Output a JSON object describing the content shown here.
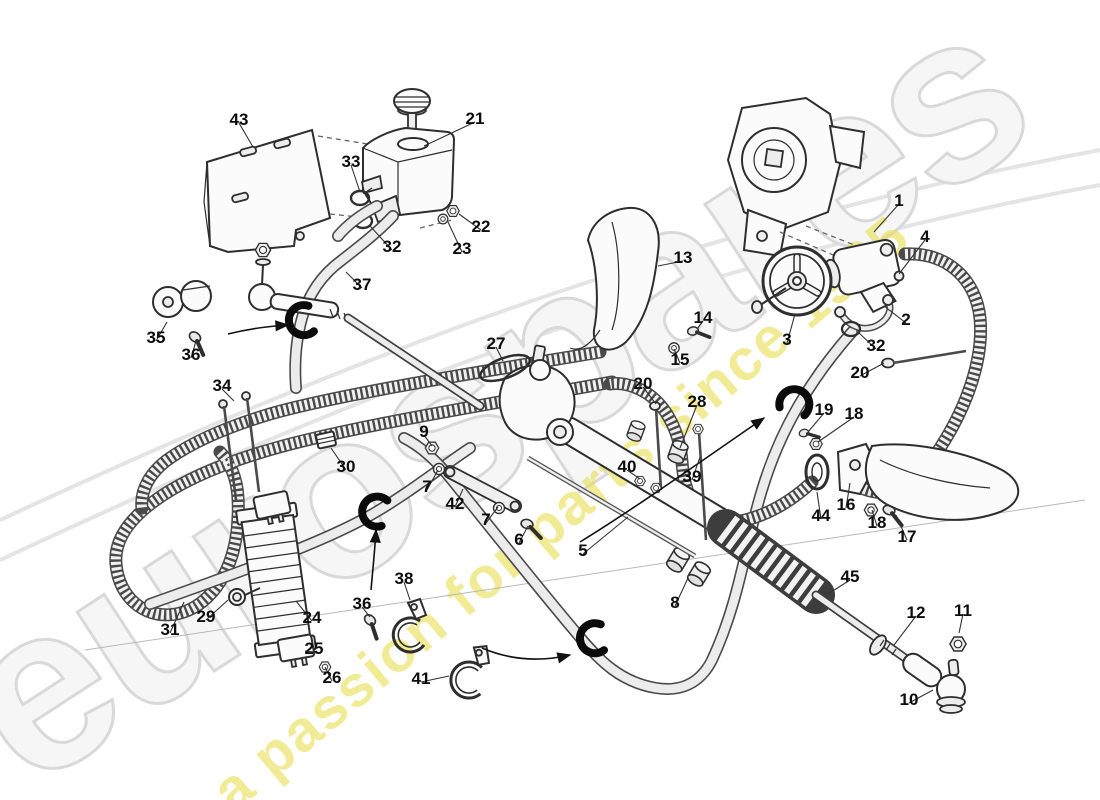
{
  "diagram": {
    "type": "exploded-parts-diagram",
    "subject": "power steering system",
    "watermark": {
      "name": "eurospares",
      "tagline": "a passion for parts since 1985",
      "logo_color": "#d9d9d9",
      "tagline_color": "#e9df55"
    },
    "callout_style": {
      "font_px": 17,
      "color": "#0d0d0d"
    },
    "callouts": [
      {
        "label": "1",
        "x": 899,
        "y": 200,
        "lx": 874,
        "ly": 232
      },
      {
        "label": "2",
        "x": 906,
        "y": 319,
        "lx": 884,
        "ly": 306
      },
      {
        "label": "3",
        "x": 787,
        "y": 339,
        "lx": 795,
        "ly": 314
      },
      {
        "label": "4",
        "x": 925,
        "y": 236,
        "lx": 899,
        "ly": 274
      },
      {
        "label": "5",
        "x": 583,
        "y": 550,
        "lx": 628,
        "ly": 517
      },
      {
        "label": "6",
        "x": 519,
        "y": 539,
        "lx": 528,
        "ly": 526
      },
      {
        "label": "7",
        "x": 427,
        "y": 486,
        "lx": 438,
        "ly": 470
      },
      {
        "label": "7",
        "x": 486,
        "y": 519,
        "lx": 498,
        "ly": 507
      },
      {
        "label": "8",
        "x": 675,
        "y": 602,
        "lx": 688,
        "ly": 578
      },
      {
        "label": "9",
        "x": 424,
        "y": 431,
        "lx": 432,
        "ly": 446
      },
      {
        "label": "10",
        "x": 909,
        "y": 699,
        "lx": 933,
        "ly": 690
      },
      {
        "label": "11",
        "x": 963,
        "y": 610,
        "lx": 959,
        "ly": 633
      },
      {
        "label": "12",
        "x": 916,
        "y": 612,
        "lx": 894,
        "ly": 645
      },
      {
        "label": "13",
        "x": 683,
        "y": 257,
        "lx": 658,
        "ly": 266
      },
      {
        "label": "14",
        "x": 703,
        "y": 317,
        "lx": 697,
        "ly": 329
      },
      {
        "label": "15",
        "x": 680,
        "y": 359,
        "lx": 674,
        "ly": 349
      },
      {
        "label": "16",
        "x": 846,
        "y": 504,
        "lx": 850,
        "ly": 483
      },
      {
        "label": "17",
        "x": 907,
        "y": 536,
        "lx": 896,
        "ly": 515
      },
      {
        "label": "18",
        "x": 854,
        "y": 413,
        "lx": 818,
        "ly": 442
      },
      {
        "label": "18",
        "x": 877,
        "y": 522,
        "lx": 872,
        "ly": 510
      },
      {
        "label": "19",
        "x": 824,
        "y": 409,
        "lx": 808,
        "ly": 432
      },
      {
        "label": "20",
        "x": 643,
        "y": 383,
        "lx": 656,
        "ly": 404
      },
      {
        "label": "20",
        "x": 860,
        "y": 372,
        "lx": 884,
        "ly": 363
      },
      {
        "label": "21",
        "x": 475,
        "y": 118,
        "lx": 424,
        "ly": 146
      },
      {
        "label": "22",
        "x": 481,
        "y": 226,
        "lx": 459,
        "ly": 214
      },
      {
        "label": "23",
        "x": 462,
        "y": 248,
        "lx": 448,
        "ly": 222
      },
      {
        "label": "24",
        "x": 312,
        "y": 617,
        "lx": 296,
        "ly": 601
      },
      {
        "label": "25",
        "x": 314,
        "y": 648,
        "lx": 305,
        "ly": 651
      },
      {
        "label": "26",
        "x": 332,
        "y": 677,
        "lx": 325,
        "ly": 667
      },
      {
        "label": "27",
        "x": 496,
        "y": 343,
        "lx": 503,
        "ly": 361
      },
      {
        "label": "28",
        "x": 697,
        "y": 401,
        "lx": 680,
        "ly": 448
      },
      {
        "label": "29",
        "x": 206,
        "y": 616,
        "lx": 228,
        "ly": 600
      },
      {
        "label": "30",
        "x": 346,
        "y": 466,
        "lx": 331,
        "ly": 448
      },
      {
        "label": "31",
        "x": 170,
        "y": 629,
        "lx": 184,
        "ly": 602
      },
      {
        "label": "32",
        "x": 392,
        "y": 246,
        "lx": 370,
        "ly": 226
      },
      {
        "label": "32",
        "x": 876,
        "y": 345,
        "lx": 858,
        "ly": 332
      },
      {
        "label": "33",
        "x": 351,
        "y": 161,
        "lx": 360,
        "ly": 192
      },
      {
        "label": "34",
        "x": 222,
        "y": 385,
        "lx": 234,
        "ly": 401
      },
      {
        "label": "35",
        "x": 156,
        "y": 337,
        "lx": 167,
        "ly": 322
      },
      {
        "label": "36",
        "x": 191,
        "y": 354,
        "lx": 196,
        "ly": 341
      },
      {
        "label": "36",
        "x": 362,
        "y": 603,
        "lx": 370,
        "ly": 617
      },
      {
        "label": "37",
        "x": 362,
        "y": 284,
        "lx": 346,
        "ly": 272
      },
      {
        "label": "38",
        "x": 404,
        "y": 578,
        "lx": 410,
        "ly": 600
      },
      {
        "label": "39",
        "x": 692,
        "y": 476,
        "lx": 700,
        "ly": 457
      },
      {
        "label": "40",
        "x": 627,
        "y": 466,
        "lx": 640,
        "ly": 479
      },
      {
        "label": "41",
        "x": 421,
        "y": 678,
        "lx": 449,
        "ly": 676
      },
      {
        "label": "42",
        "x": 455,
        "y": 503,
        "lx": 463,
        "ly": 489
      },
      {
        "label": "43",
        "x": 239,
        "y": 119,
        "lx": 253,
        "ly": 147
      },
      {
        "label": "44",
        "x": 821,
        "y": 515,
        "lx": 817,
        "ly": 492
      },
      {
        "label": "45",
        "x": 850,
        "y": 576,
        "lx": 828,
        "ly": 594
      }
    ],
    "pointer_arrows": [
      {
        "d": "M228,334 C252,328 272,326 288,325"
      },
      {
        "d": "M371,590 C373,568 375,548 376,530"
      },
      {
        "d": "M482,648 C510,660 540,662 570,655"
      },
      {
        "d": "M580,542 C640,505 710,455 764,418"
      }
    ],
    "hose_clips": [
      {
        "x": 303,
        "y": 321,
        "rot": -10
      },
      {
        "x": 376,
        "y": 512,
        "rot": 15
      },
      {
        "x": 594,
        "y": 639,
        "rot": -5
      },
      {
        "x": 794,
        "y": 403,
        "rot": 110
      }
    ]
  }
}
